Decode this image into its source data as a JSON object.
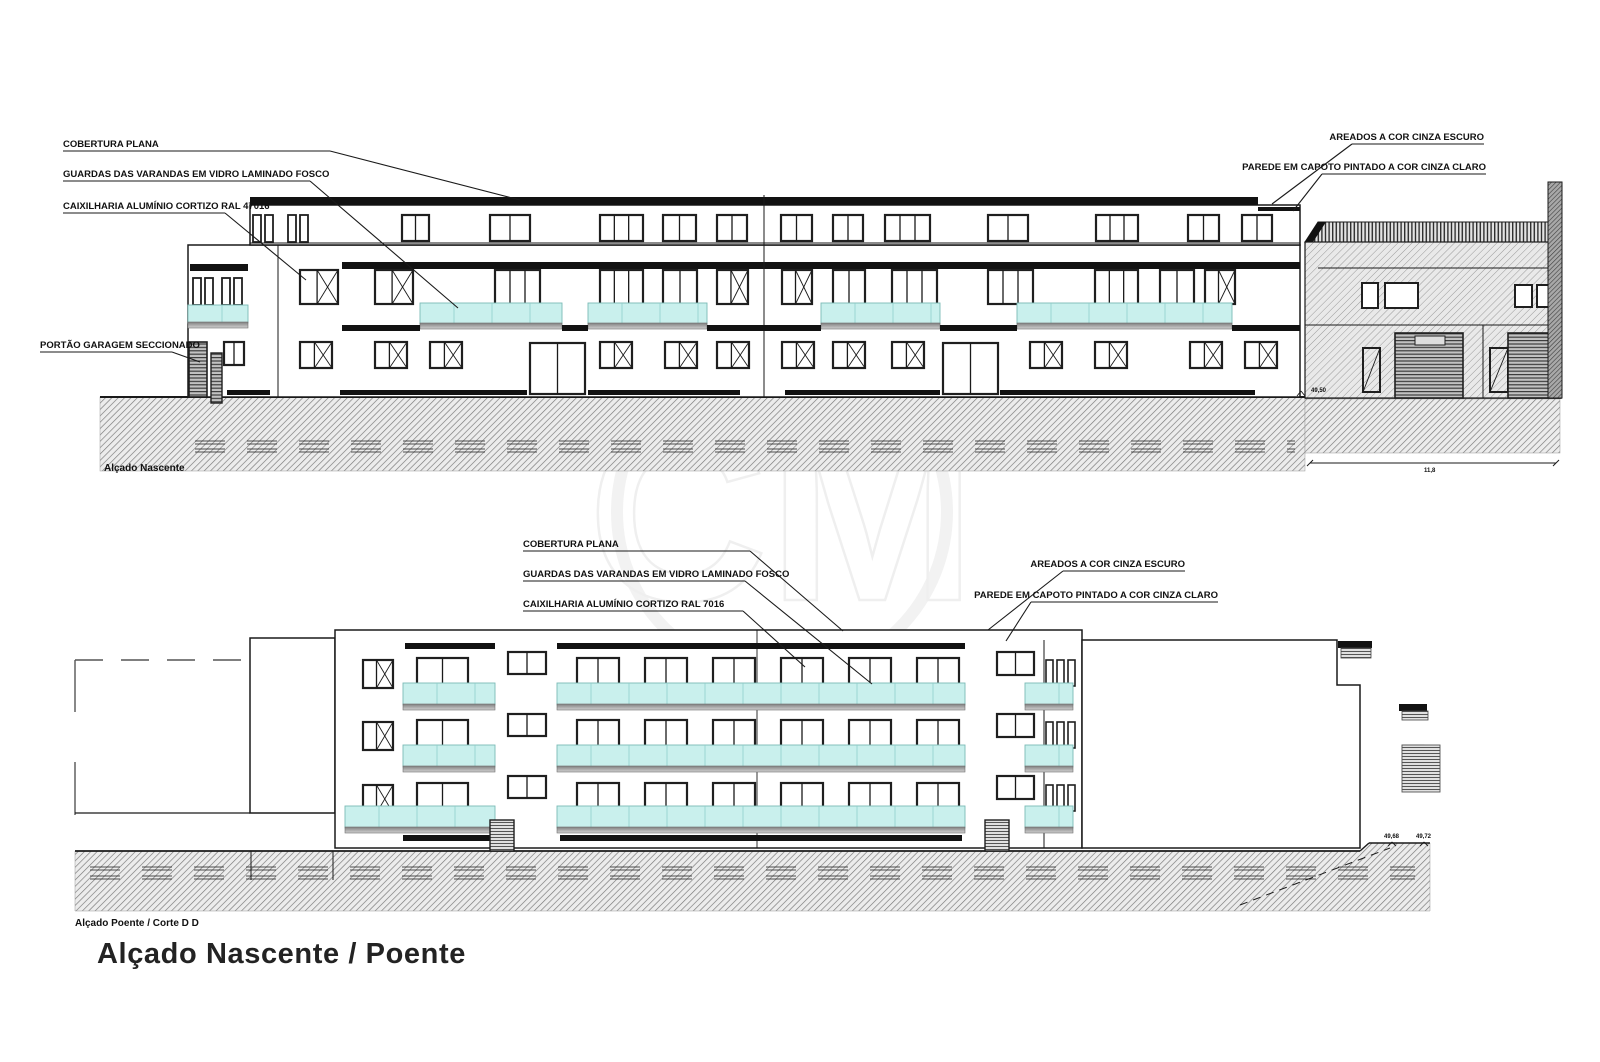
{
  "page_title": "Alçado Nascente / Poente",
  "watermark_text": "CM",
  "colors": {
    "glass": "#c9f0ed",
    "ink": "#1a1a1a",
    "band": "#121212"
  },
  "elevation_top": {
    "caption": "Alçado Nascente",
    "labels": {
      "cobertura": "COBERTURA PLANA",
      "guardas": "GUARDAS DAS VARANDAS EM VIDRO LAMINADO FOSCO",
      "caixilharia": "CAIXILHARIA ALUMÍNIO CORTIZO RAL 47016",
      "portao": "PORTÃO GARAGEM SECCIONADO",
      "areados": "AREADOS A COR CINZA ESCURO",
      "parede": "PAREDE EM CAPOTO PINTADO A COR CINZA CLARO"
    },
    "level_mark": "49,50",
    "dimension": "11,8"
  },
  "elevation_bottom": {
    "caption": "Alçado Poente / Corte D D",
    "labels": {
      "cobertura": "COBERTURA PLANA",
      "guardas": "GUARDAS DAS VARANDAS EM VIDRO LAMINADO FOSCO",
      "caixilharia": "CAIXILHARIA ALUMÍNIO CORTIZO RAL 7016",
      "areados": "AREADOS A COR CINZA ESCURO",
      "parede": "PAREDE EM CAPOTO PINTADO A COR CINZA CLARO"
    },
    "level_marks": [
      "49,68",
      "49,72"
    ]
  }
}
